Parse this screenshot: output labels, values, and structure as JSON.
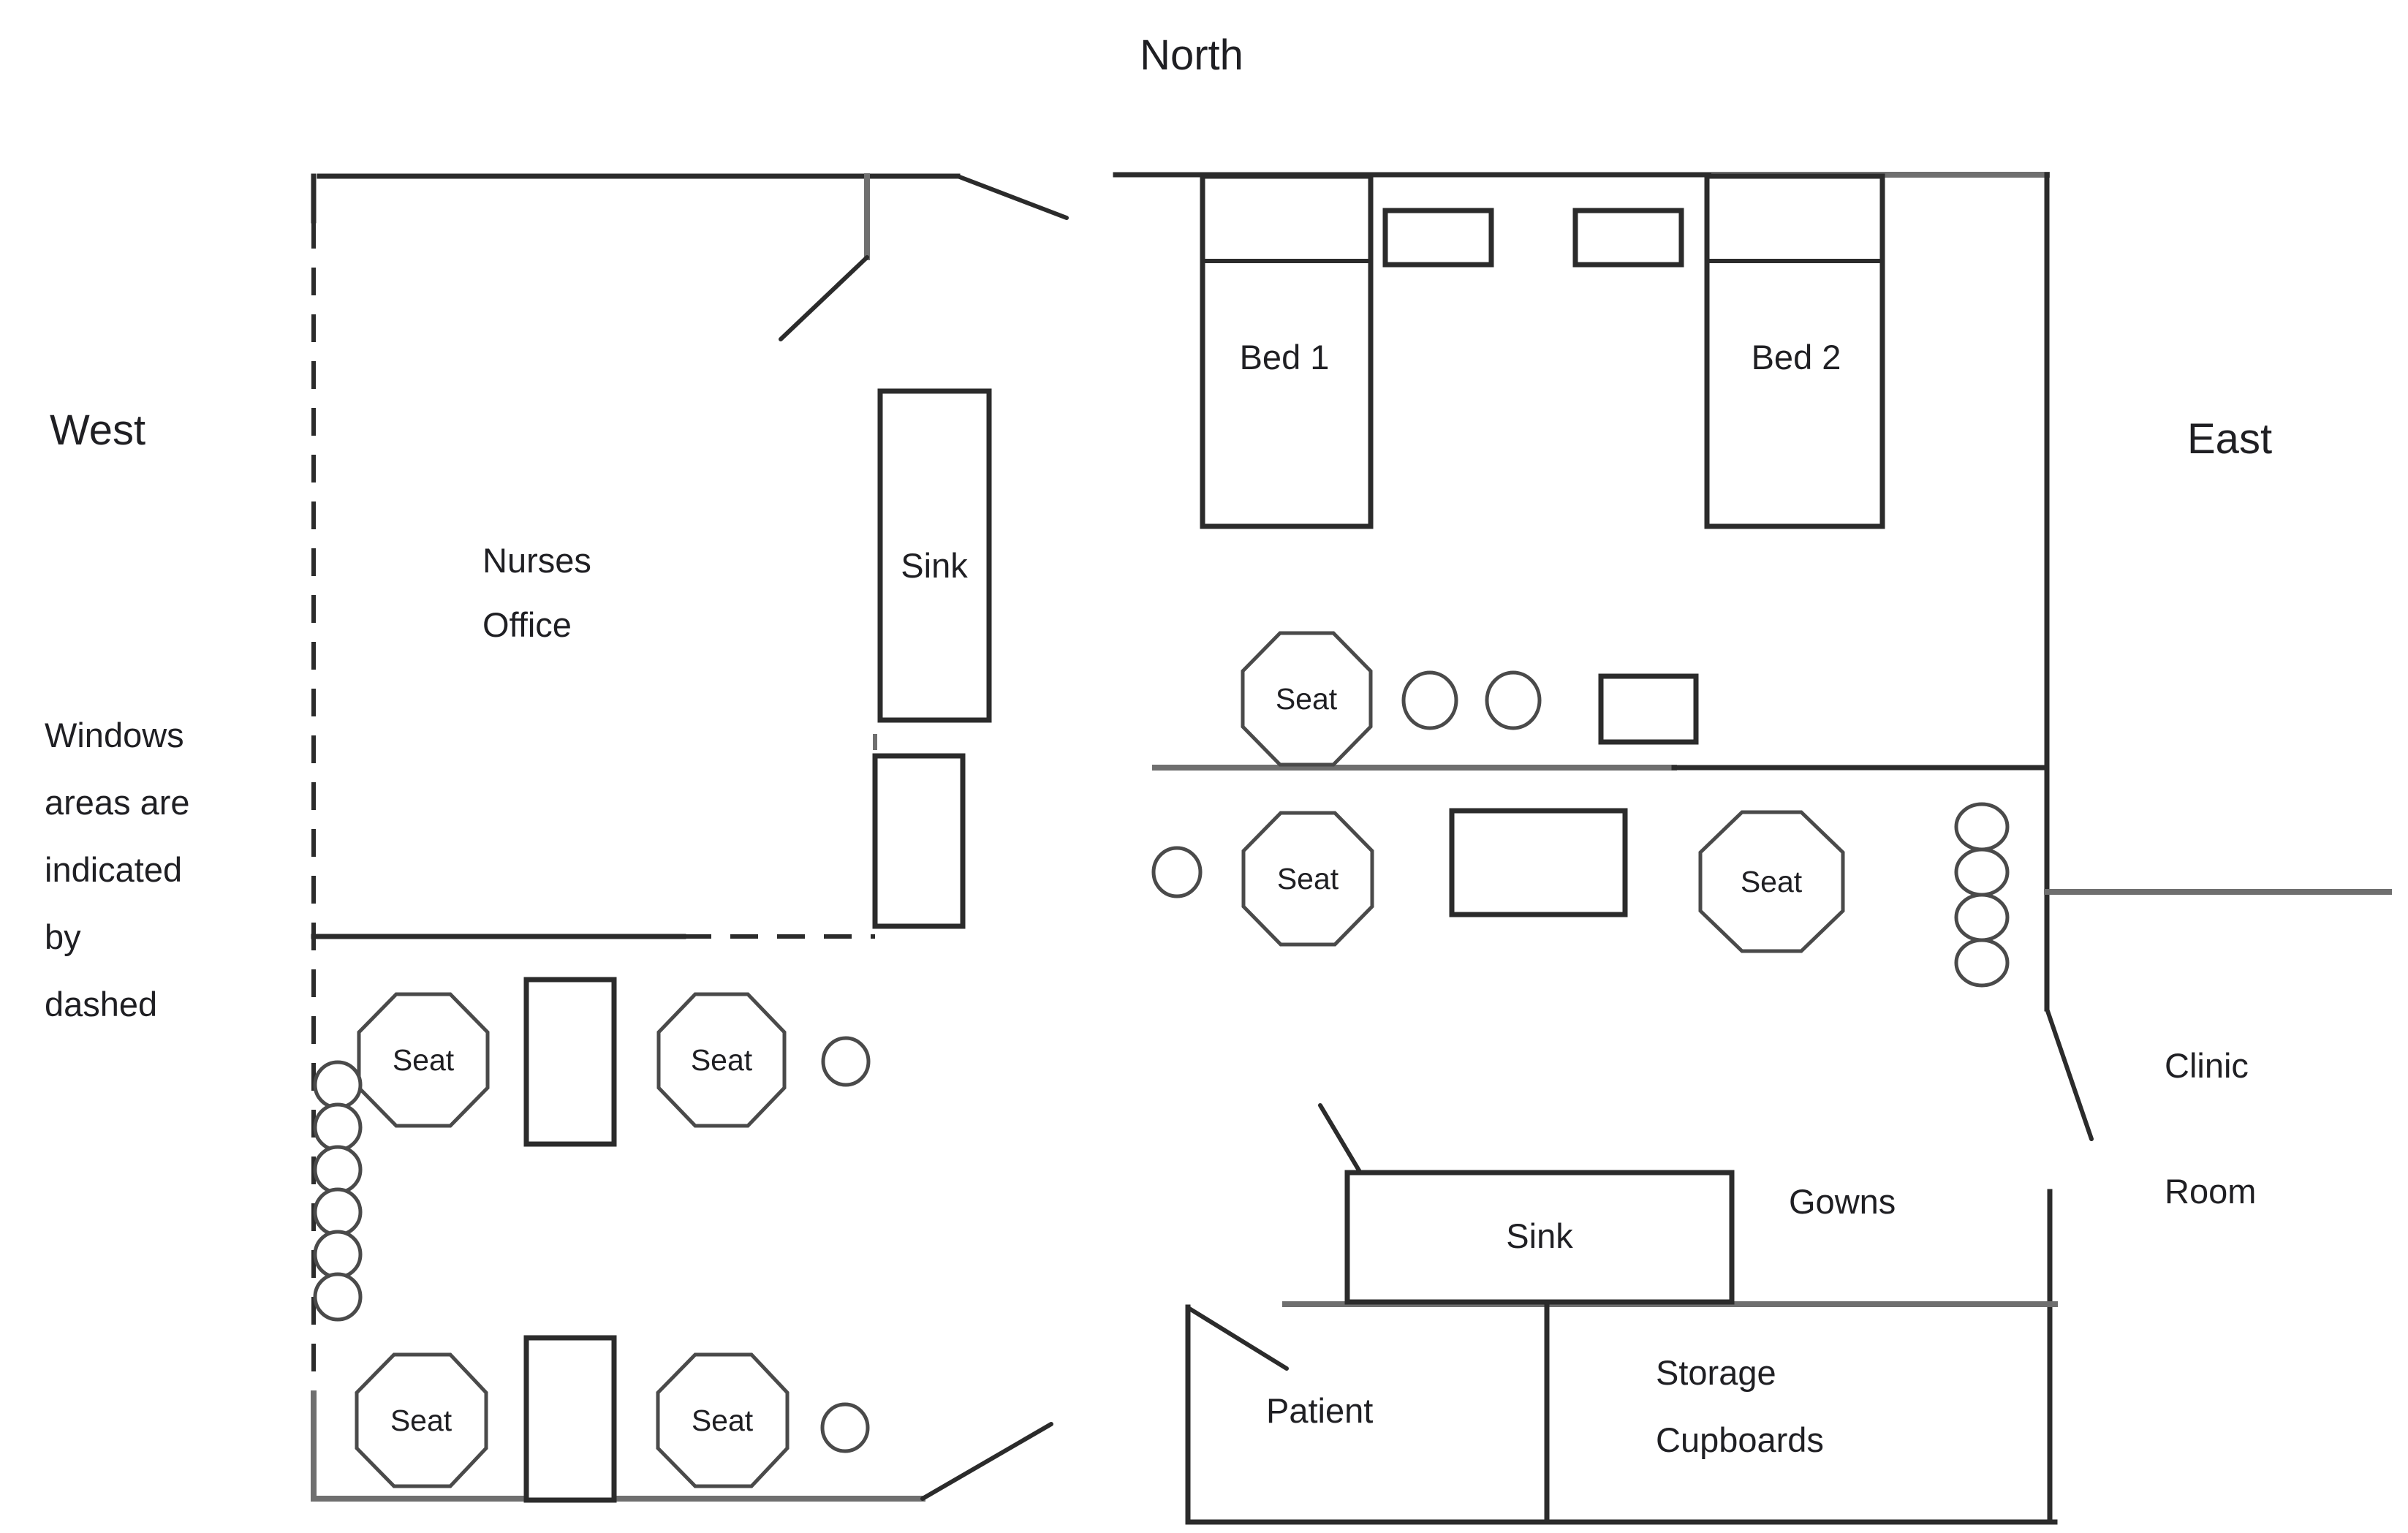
{
  "compass": {
    "north": "North",
    "west": "West",
    "east": "East"
  },
  "window_note": {
    "lines": [
      "Windows",
      "areas are",
      "indicated",
      "by",
      "dashed"
    ]
  },
  "rooms": {
    "nurses_office": {
      "line1": "Nurses",
      "line2": "Office"
    },
    "clinic_room": {
      "line1": "Clinic",
      "line2": "Room"
    }
  },
  "furniture": {
    "bed1": "Bed 1",
    "bed2": "Bed 2",
    "sink_nurses": "Sink",
    "sink_treatment": "Sink",
    "gowns": "Gowns",
    "patient": "Patient",
    "storage": {
      "line1": "Storage",
      "line2": "Cupboards"
    },
    "seats": [
      "Seat",
      "Seat",
      "Seat",
      "Seat",
      "Seat",
      "Seat",
      "Seat"
    ]
  },
  "colors": {
    "wall": "#2b2b2b",
    "wall_gray": "#6f6f6f",
    "furniture_light": "#4a4a4a",
    "text": "#1f1f23",
    "background": "#ffffff"
  }
}
